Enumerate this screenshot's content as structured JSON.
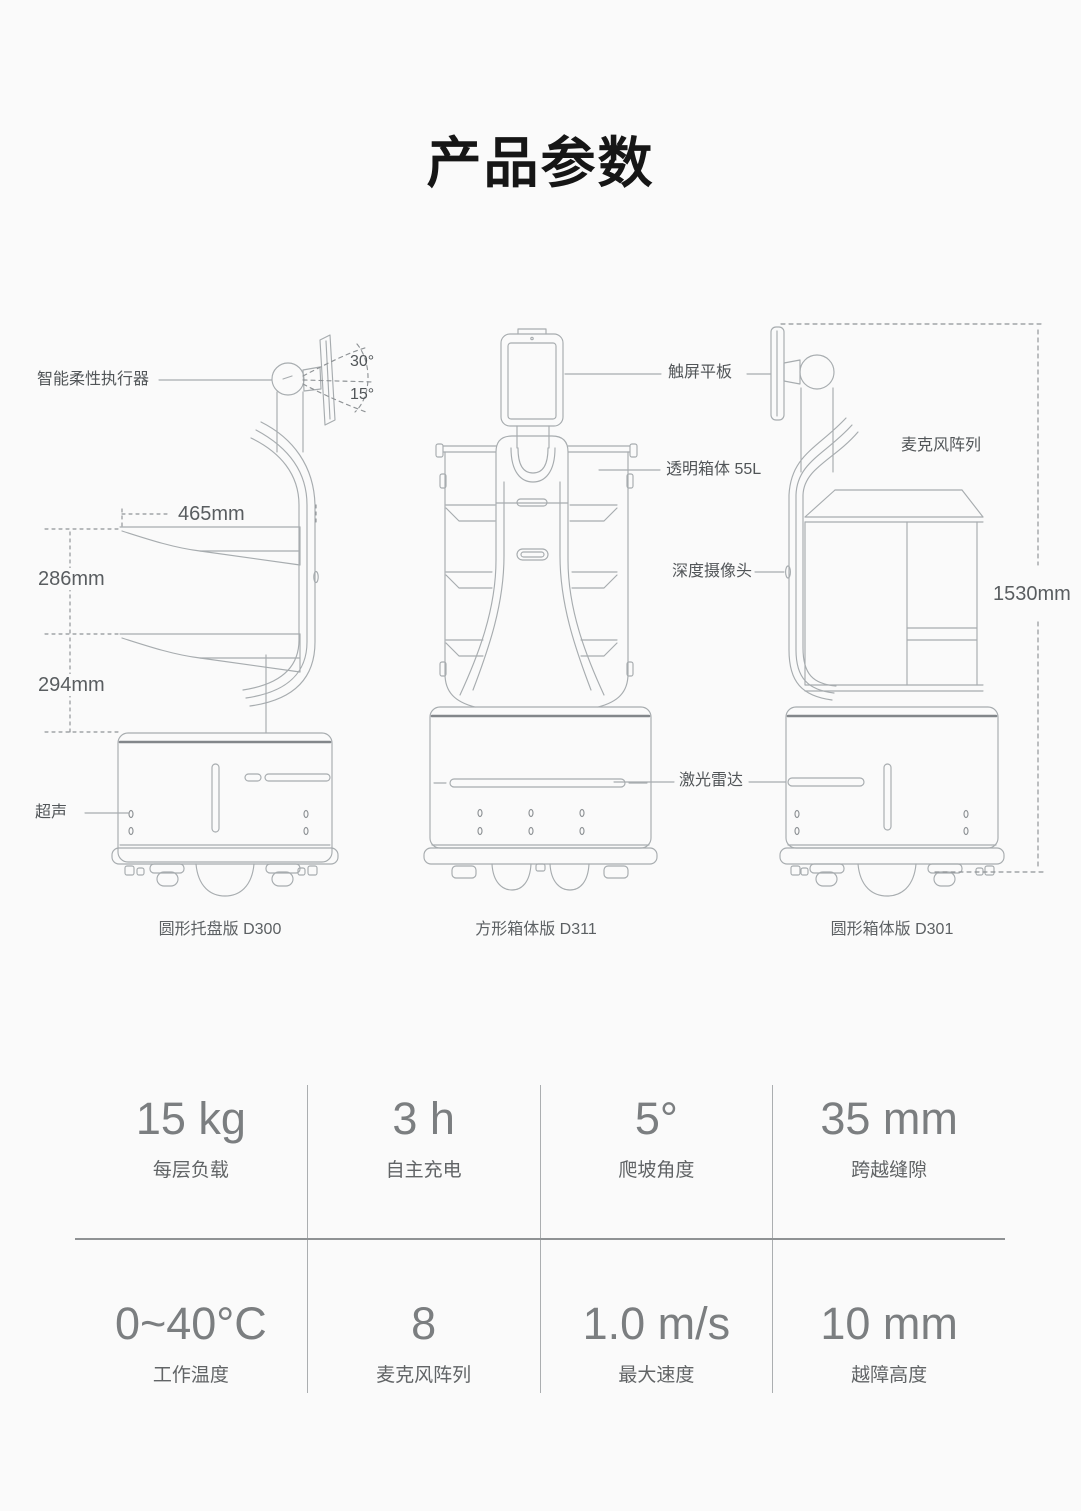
{
  "page": {
    "title": "产品参数"
  },
  "diagram": {
    "models": [
      {
        "caption": "圆形托盘版 D300"
      },
      {
        "caption": "方形箱体版 D311"
      },
      {
        "caption": "圆形箱体版 D301"
      }
    ],
    "callouts": {
      "actuator": "智能柔性执行器",
      "angle_up": "30°",
      "angle_down": "15°",
      "tray_width": "465mm",
      "tray_gap_upper": "286mm",
      "tray_gap_lower": "294mm",
      "ultrasonic": "超声",
      "touchscreen": "触屏平板",
      "transparent_box": "透明箱体 55L",
      "depth_camera": "深度摄像头",
      "lidar": "激光雷达",
      "mic_array": "麦克风阵列",
      "height": "1530mm"
    }
  },
  "specs": {
    "rows": [
      [
        {
          "value": "15 kg",
          "label": "每层负载"
        },
        {
          "value": "3 h",
          "label": "自主充电"
        },
        {
          "value": "5°",
          "label": "爬坡角度"
        },
        {
          "value": "35 mm",
          "label": "跨越缝隙"
        }
      ],
      [
        {
          "value": "0~40°C",
          "label": "工作温度"
        },
        {
          "value": "8",
          "label": "麦克风阵列"
        },
        {
          "value": "1.0 m/s",
          "label": "最大速度"
        },
        {
          "value": "10 mm",
          "label": "越障高度"
        }
      ]
    ]
  },
  "colors": {
    "background": "#fafafa",
    "line_art": "#a7acaf",
    "text_dark": "#161616",
    "spec_value": "#7b7e80"
  }
}
